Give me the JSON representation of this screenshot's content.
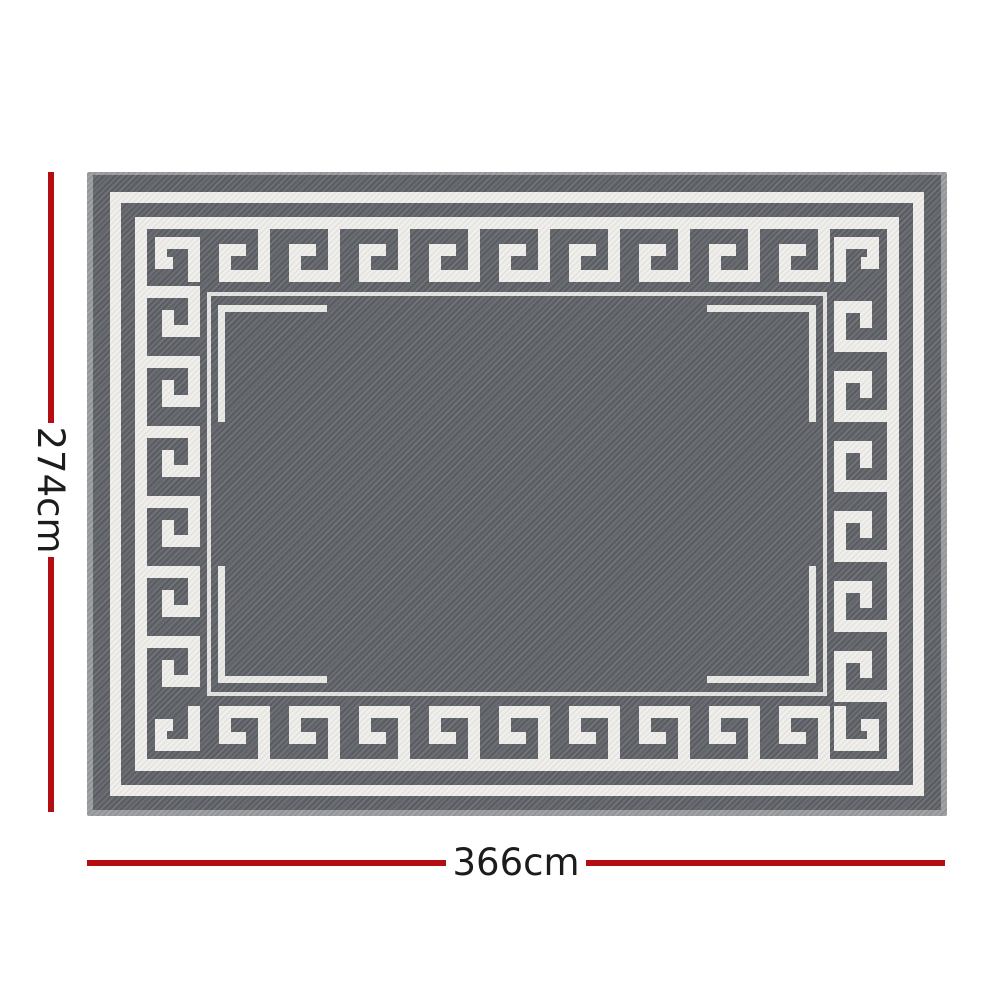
{
  "diagram": {
    "type": "product-dimension-diagram",
    "product": "Outdoor rug / camping mat with Greek key border pattern",
    "pattern": "greek-key-meander",
    "height": {
      "label": "274cm",
      "value_cm": 274
    },
    "width": {
      "label": "366cm",
      "value_cm": 366
    }
  },
  "colors": {
    "background": "#ffffff",
    "rug_base": "#5d6065",
    "rug_pattern_white": "#efeeeb",
    "rug_binding": "#989a9d",
    "dimension_line_red": "#b40d12",
    "dimension_text": "#1c1c1c"
  }
}
